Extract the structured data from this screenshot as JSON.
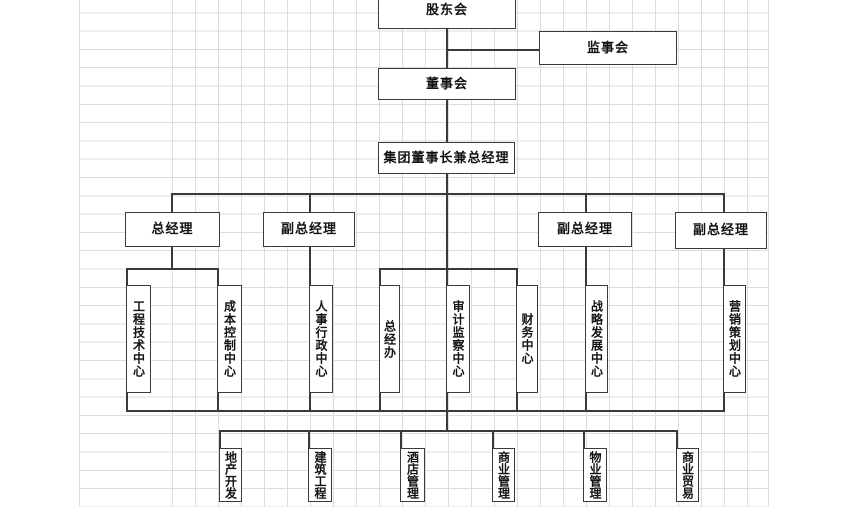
{
  "theme": {
    "canvas_bg": "#ffffff",
    "grid_line_color": "#dcdcdc",
    "connector_color": "#3a3a3a",
    "box_border_color": "#3a3a3a",
    "box_fill": "#ffffff",
    "text_color": "#121212"
  },
  "org_chart": {
    "nodes": {
      "shareholders_meeting": {
        "label": "股东会"
      },
      "supervisory_board": {
        "label": "监事会"
      },
      "board_of_directors": {
        "label": "董事会"
      },
      "chairman_and_gm": {
        "label": "集团董事长兼总经理"
      },
      "general_manager": {
        "label": "总经理"
      },
      "deputy_gm_1": {
        "label": "副总经理"
      },
      "deputy_gm_2": {
        "label": "副总经理"
      },
      "deputy_gm_3": {
        "label": "副总经理"
      },
      "engineering_tech_center": {
        "label": "工程技术中心"
      },
      "cost_control_center": {
        "label": "成本控制中心"
      },
      "hr_admin_center": {
        "label": "人事行政中心"
      },
      "gm_office": {
        "label": "总经办"
      },
      "audit_supervision_center": {
        "label": "审计监察中心"
      },
      "finance_center": {
        "label": "财务中心"
      },
      "strategic_dev_center": {
        "label": "战略发展中心"
      },
      "marketing_planning_center": {
        "label": "营销策划中心"
      },
      "real_estate_dev": {
        "label": "地产开发"
      },
      "construction_eng": {
        "label": "建筑工程"
      },
      "hotel_management": {
        "label": "酒店管理"
      },
      "commercial_management": {
        "label": "商业管理"
      },
      "property_management": {
        "label": "物业管理"
      },
      "commercial_trade": {
        "label": "商业贸易"
      }
    }
  }
}
